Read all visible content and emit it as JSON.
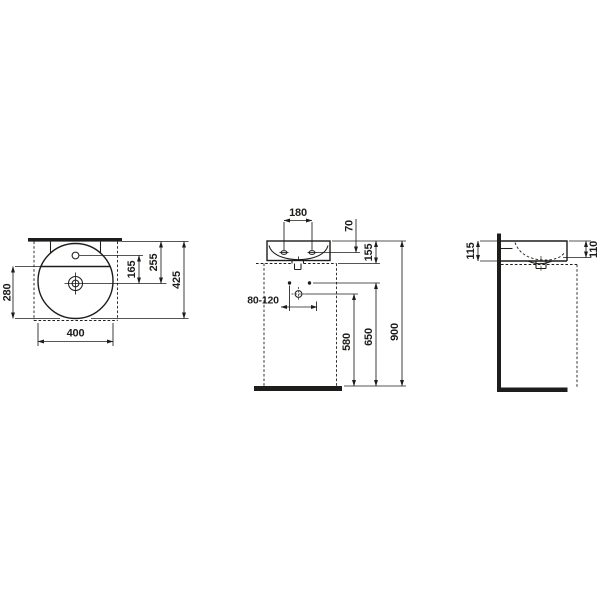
{
  "theme": {
    "ink": "#1d1d1b",
    "bg": "#ffffff"
  },
  "drawing": {
    "title": "wall-mounted washbasin dimensional drawing",
    "top_view": {
      "bowl_diameter": "400",
      "bowl_depth": "280",
      "tap_to_drain": "165",
      "wall_to_drain": "255",
      "total_depth": "425"
    },
    "front_view": {
      "tap_hole_spacing": "180",
      "rim_to_tap_hole": "70",
      "basin_height": "155",
      "drain_offset_range": "80-120",
      "drain_height": "580",
      "fixing_height": "650",
      "rim_height": "900"
    },
    "side_view": {
      "rear_height": "115",
      "front_height": "110"
    }
  }
}
